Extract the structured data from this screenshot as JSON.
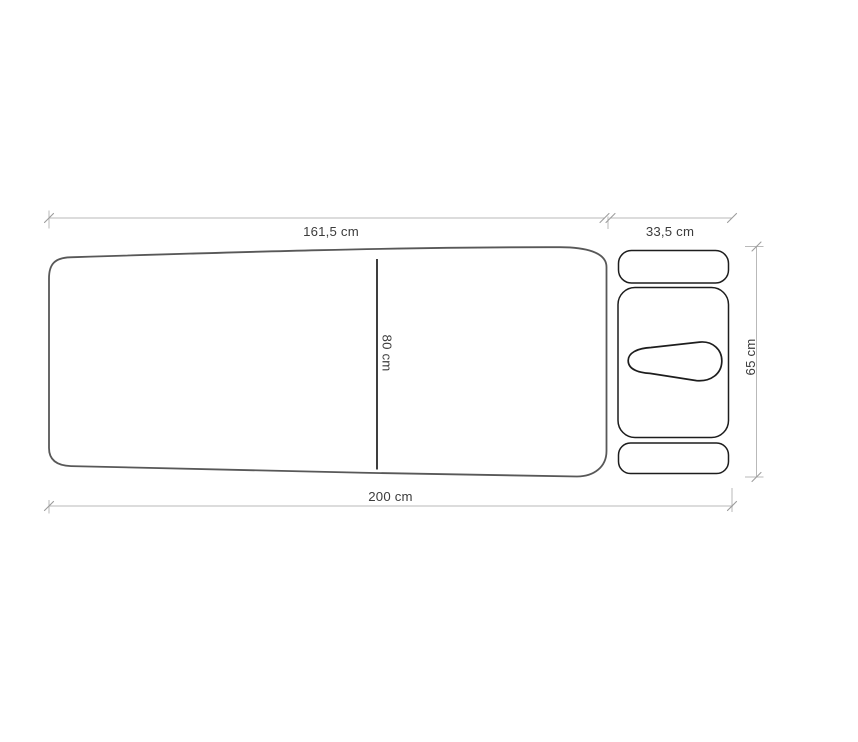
{
  "diagram": {
    "kind": "top-view dimension drawing of a folding massage table with headrest cushions",
    "labels": {
      "table_length_top": "161,5 cm",
      "headrest_length_top": "33,5 cm",
      "table_width_mid": "80 cm",
      "total_length_bottom": "200 cm",
      "overall_width_right": "65 cm"
    },
    "colors": {
      "background": "#ffffff",
      "table_outline": "#585858",
      "part_outline": "#1d1d1d",
      "dimension_line": "#b9b9b9",
      "dimension_tick": "#9c9c9c",
      "label_text": "#3c3c3c"
    }
  }
}
